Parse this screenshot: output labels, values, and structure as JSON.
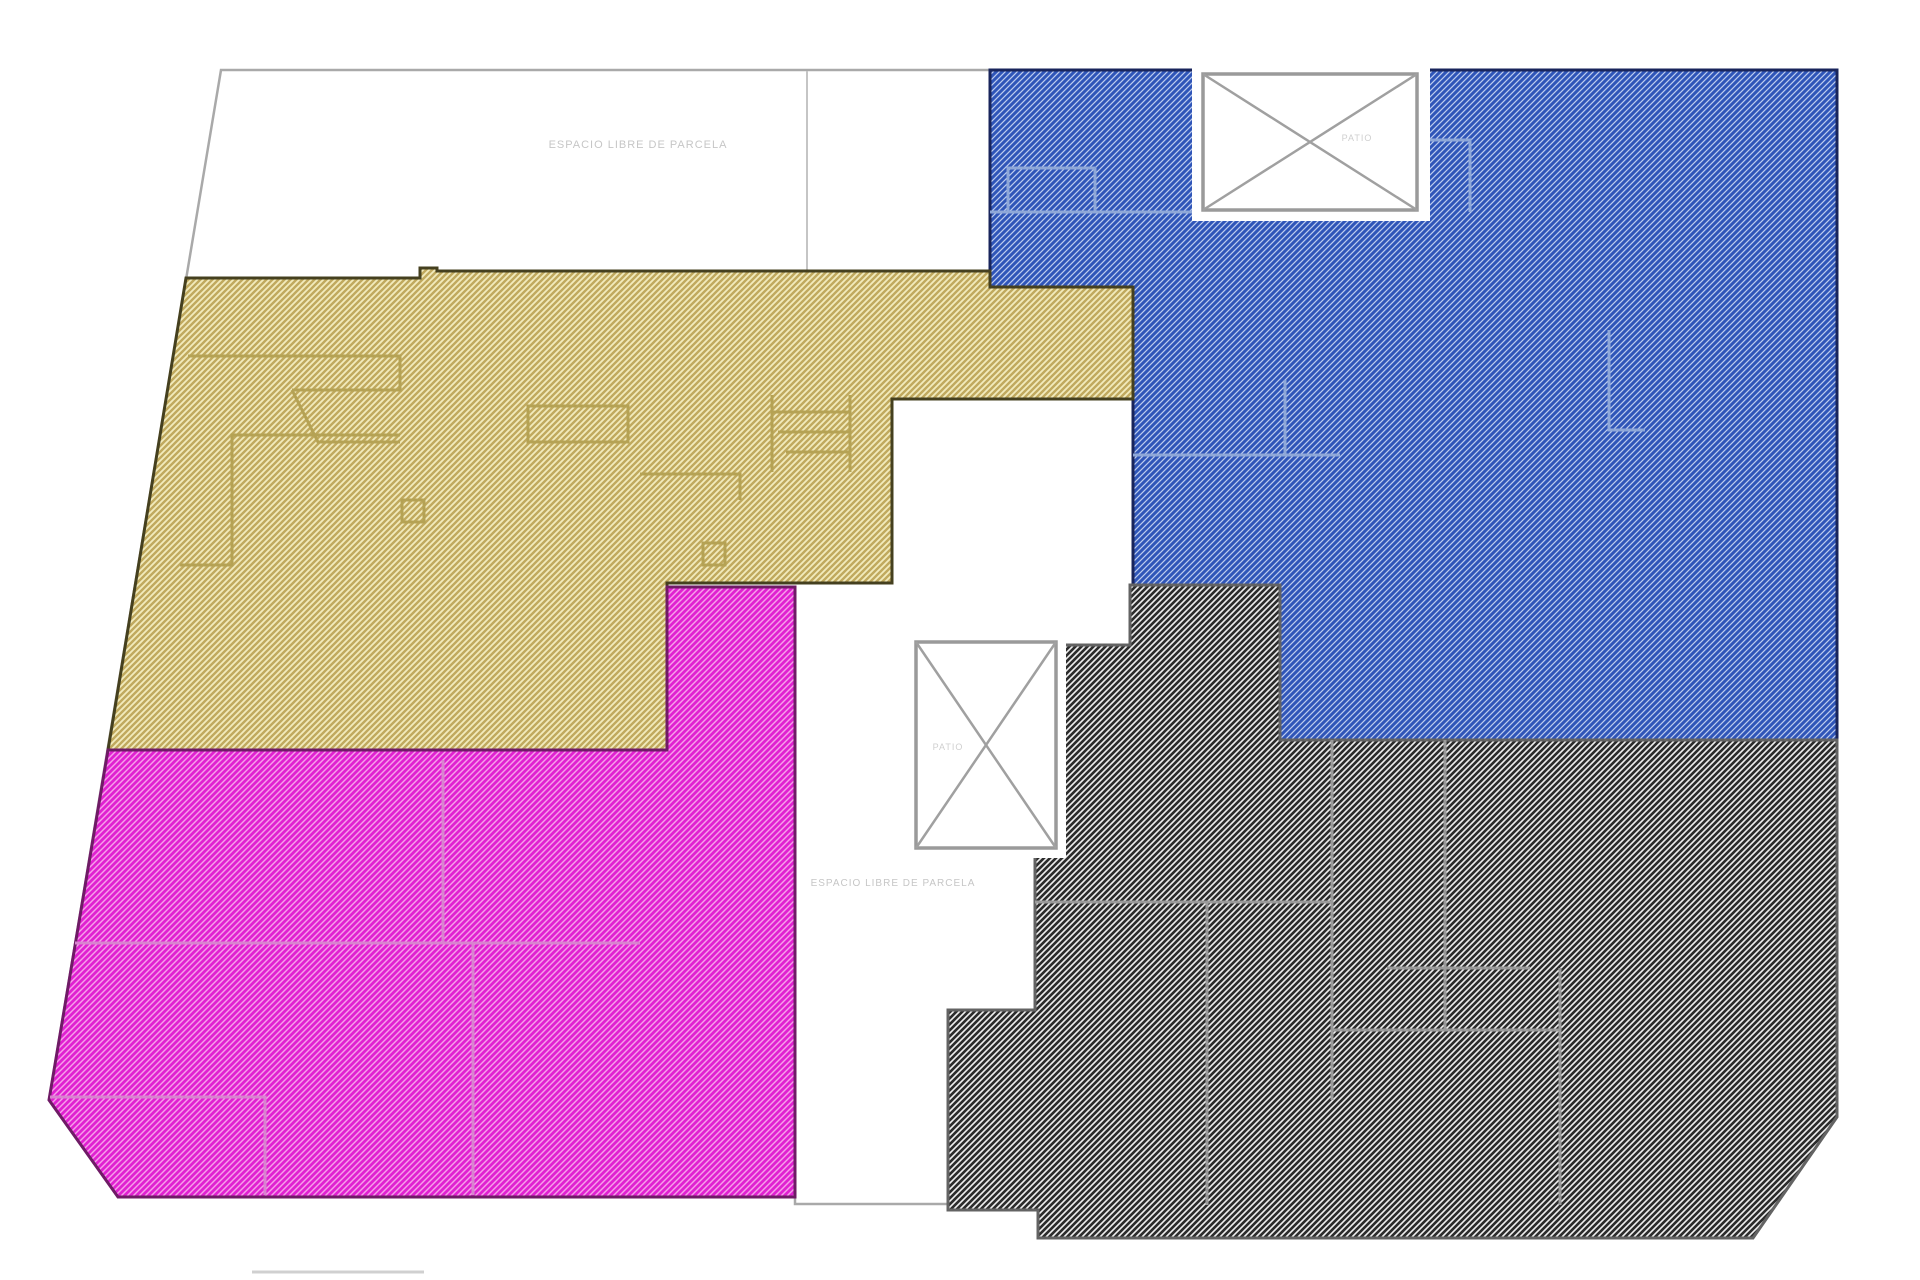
{
  "document": {
    "type": "site-floor-plan",
    "description": "Parcel plan with four hatched building zones and two cross-marked light wells"
  },
  "labels": {
    "courtyard_top": "ESPACIO LIBRE DE PARCELA",
    "courtyard_bottom": "ESPACIO LIBRE DE PARCELA",
    "lightwell_top": "PATIO",
    "lightwell_middle": "PATIO"
  },
  "regions": {
    "parcel": {
      "name": "parcel outline",
      "fill": "#ffffff",
      "stroke": "#a9a9a9"
    },
    "unit_yellow": {
      "name": "zone yellow",
      "bg": "#f2ebbd",
      "hatch": "#c0a95e",
      "border": "#45401f",
      "wall": "#b5a254"
    },
    "unit_blue": {
      "name": "zone blue",
      "bg": "#bccbee",
      "hatch": "#2f55b8",
      "border": "#19255c",
      "wall": "#8fa8d8"
    },
    "unit_magenta": {
      "name": "zone magenta",
      "bg": "#f6a0ea",
      "hatch": "#e021d1",
      "border": "#6f1b66",
      "wall": "#d884cf"
    },
    "unit_gray": {
      "name": "zone gray",
      "bg": "#efefef",
      "hatch": "#2c2c2c",
      "border": "#636363",
      "wall": "#9a9a9a"
    },
    "lightwell": {
      "fill": "#ffffff",
      "stroke": "#9a9a9a",
      "cross": "#a0a0a0"
    }
  },
  "annotation_colors": {
    "courtyard_label": "#c6c6c6",
    "lightwell_label": "#cfcfcf",
    "courtyard_divider": "#c5c5c5",
    "boundary_tick": "#d0d0d0"
  }
}
